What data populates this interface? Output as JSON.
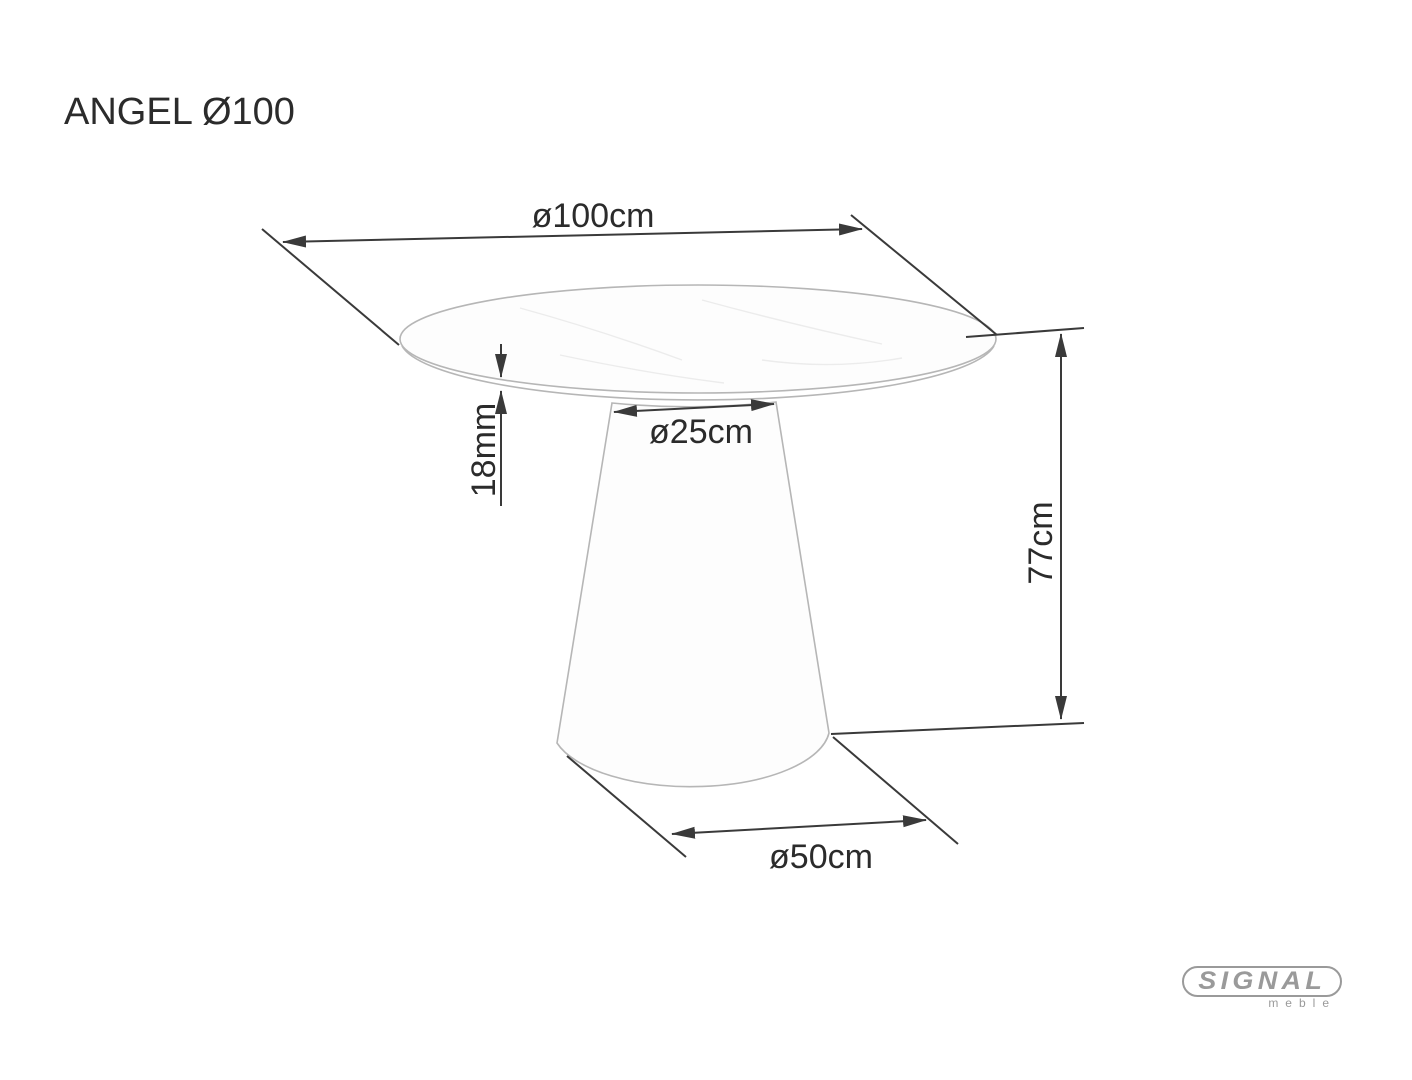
{
  "page": {
    "title": "ANGEL Ø100"
  },
  "drawing": {
    "subject": "round-pedestal-table",
    "dimensions": {
      "top_diameter": "ø100cm",
      "top_thickness": "18mm",
      "column_diameter": "ø25cm",
      "height": "77cm",
      "base_diameter": "ø50cm"
    }
  },
  "logo": {
    "brand": "SIGNAL",
    "subtitle": "meble"
  },
  "colors": {
    "background": "#ffffff",
    "text": "#2b2b2b",
    "dimension_line": "#3a3a3a",
    "table_outline": "#b6b6b6",
    "table_fill": "#fdfdfd",
    "marble_vein": "#ececec",
    "logo_gray": "#9a9a9a"
  }
}
